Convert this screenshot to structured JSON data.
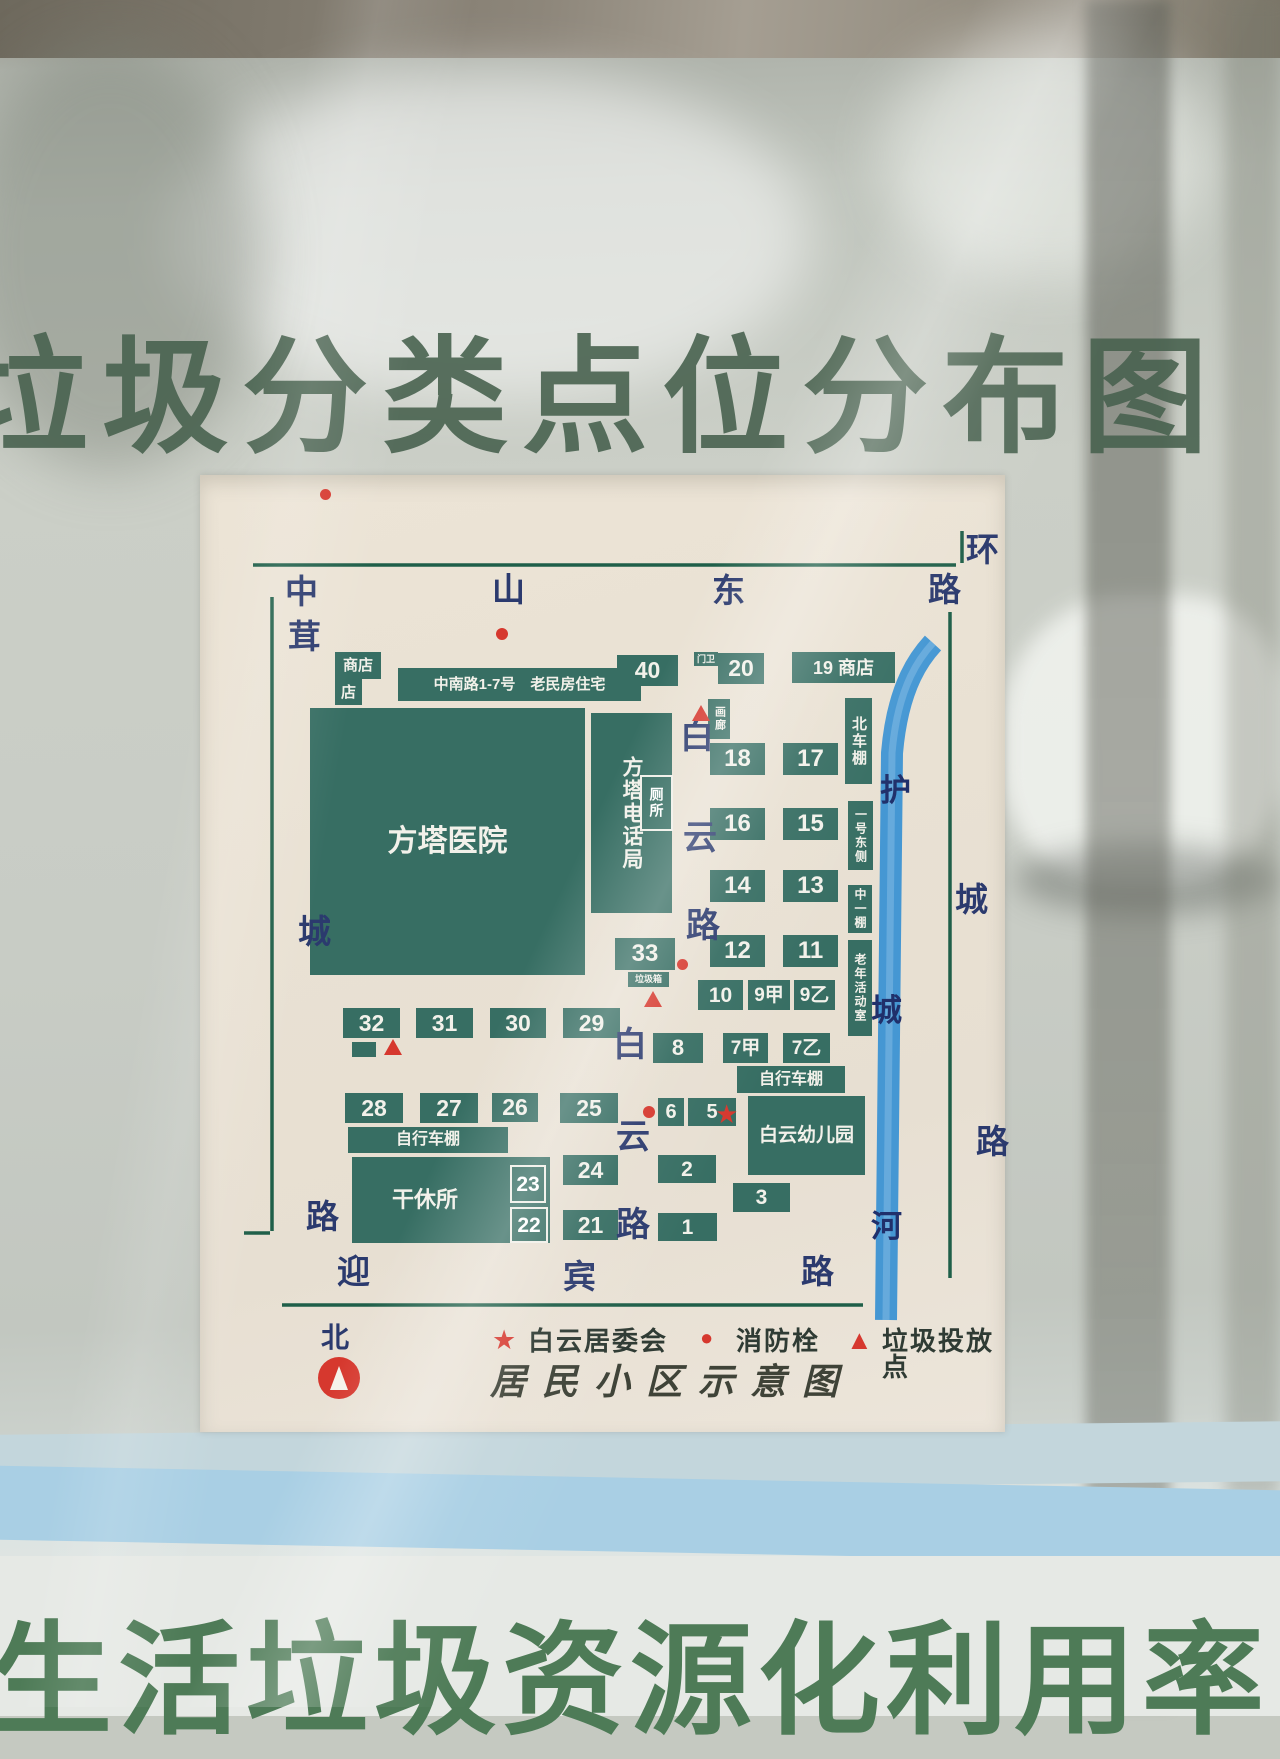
{
  "banners": {
    "top_title": "垃圾分类点位分布图",
    "bottom_banner": "生活垃圾资源化利用率"
  },
  "poster": {
    "caption": "居民小区示意图",
    "compass_label": "北",
    "road_names": {
      "top": "中山东路",
      "left": "茸城路",
      "right": "环城路",
      "bottom": "迎宾路",
      "inner": "白云路",
      "river": "护城河"
    },
    "legend": [
      {
        "symbol": "star",
        "glyph": "★",
        "label": "白云居委会"
      },
      {
        "symbol": "dot",
        "glyph": "●",
        "label": "消防栓"
      },
      {
        "symbol": "triangle",
        "glyph": "▲",
        "label": "垃圾投放点"
      }
    ],
    "colors": {
      "building_green": "#376e63",
      "road_line_green": "#1f5f49",
      "river_blue": "#4597d3",
      "marker_red": "#d6382e",
      "road_text_navy": "#2b3a6e"
    },
    "items": [
      {
        "name": "building-shop-upper",
        "type": "building",
        "x": 135,
        "y": 177,
        "w": 46,
        "h": 27,
        "label": "商店",
        "fs": 15
      },
      {
        "name": "building-shop-lower",
        "type": "building",
        "x": 135,
        "y": 204,
        "w": 27,
        "h": 26,
        "label": "店",
        "fs": 15
      },
      {
        "name": "building-zhongnan-housing",
        "type": "building",
        "x": 198,
        "y": 193,
        "w": 243,
        "h": 33,
        "label": "中南路1-7号　老民房住宅",
        "fs": 15
      },
      {
        "name": "building-40",
        "type": "building",
        "x": 417,
        "y": 180,
        "w": 61,
        "h": 31,
        "label": "40",
        "fs": 23
      },
      {
        "name": "label-gatehouse",
        "type": "building",
        "x": 494,
        "y": 177,
        "w": 24,
        "h": 14,
        "label": "门卫",
        "fs": 9
      },
      {
        "name": "building-20",
        "type": "building",
        "x": 518,
        "y": 178,
        "w": 46,
        "h": 31,
        "label": "20",
        "fs": 23
      },
      {
        "name": "building-19-shop",
        "type": "building",
        "x": 592,
        "y": 177,
        "w": 103,
        "h": 31,
        "label": "19 商店",
        "fs": 18
      },
      {
        "name": "building-fangta-hospital",
        "type": "building",
        "x": 110,
        "y": 233,
        "w": 275,
        "h": 267,
        "label": "方塔医院",
        "fs": 30
      },
      {
        "name": "building-fangta-telephone",
        "type": "building",
        "x": 391,
        "y": 238,
        "w": 81,
        "h": 200,
        "label": "方塔电话局",
        "fs": 21,
        "vertical": true
      },
      {
        "name": "building-toilet",
        "type": "outline",
        "x": 440,
        "y": 300,
        "w": 33,
        "h": 56,
        "label": "厕所",
        "fs": 14,
        "vertical": true
      },
      {
        "name": "building-gallery",
        "type": "building",
        "x": 508,
        "y": 224,
        "w": 22,
        "h": 40,
        "label": "画廊",
        "fs": 11,
        "vertical": true
      },
      {
        "name": "building-18",
        "type": "building",
        "x": 510,
        "y": 268,
        "w": 55,
        "h": 32,
        "label": "18",
        "fs": 24
      },
      {
        "name": "building-17",
        "type": "building",
        "x": 583,
        "y": 268,
        "w": 55,
        "h": 32,
        "label": "17",
        "fs": 24
      },
      {
        "name": "building-16",
        "type": "building",
        "x": 510,
        "y": 333,
        "w": 55,
        "h": 32,
        "label": "16",
        "fs": 24
      },
      {
        "name": "building-15",
        "type": "building",
        "x": 583,
        "y": 333,
        "w": 55,
        "h": 32,
        "label": "15",
        "fs": 24
      },
      {
        "name": "building-14",
        "type": "building",
        "x": 510,
        "y": 395,
        "w": 55,
        "h": 32,
        "label": "14",
        "fs": 24
      },
      {
        "name": "building-13",
        "type": "building",
        "x": 583,
        "y": 395,
        "w": 55,
        "h": 32,
        "label": "13",
        "fs": 24
      },
      {
        "name": "building-12",
        "type": "building",
        "x": 510,
        "y": 460,
        "w": 55,
        "h": 32,
        "label": "12",
        "fs": 24
      },
      {
        "name": "building-11",
        "type": "building",
        "x": 583,
        "y": 460,
        "w": 55,
        "h": 32,
        "label": "11",
        "fs": 24
      },
      {
        "name": "building-north-bike-shed",
        "type": "building",
        "x": 645,
        "y": 223,
        "w": 27,
        "h": 86,
        "label": "北车棚",
        "fs": 15,
        "vertical": true
      },
      {
        "name": "building-no1-east-side",
        "type": "building",
        "x": 648,
        "y": 326,
        "w": 25,
        "h": 69,
        "label": "一号东侧",
        "fs": 12,
        "vertical": true
      },
      {
        "name": "building-middle-shed",
        "type": "building",
        "x": 648,
        "y": 410,
        "w": 24,
        "h": 48,
        "label": "中一棚",
        "fs": 12,
        "vertical": true
      },
      {
        "name": "building-senior-activity-room",
        "type": "building",
        "x": 648,
        "y": 465,
        "w": 24,
        "h": 96,
        "label": "老年活动室",
        "fs": 12,
        "vertical": true
      },
      {
        "name": "building-33",
        "type": "building",
        "x": 415,
        "y": 463,
        "w": 60,
        "h": 32,
        "label": "33",
        "fs": 24
      },
      {
        "name": "label-garbage-bin",
        "type": "building",
        "x": 428,
        "y": 497,
        "w": 41,
        "h": 15,
        "label": "垃圾箱",
        "fs": 9
      },
      {
        "name": "building-10",
        "type": "building",
        "x": 498,
        "y": 505,
        "w": 45,
        "h": 30,
        "label": "10",
        "fs": 21
      },
      {
        "name": "building-9jia",
        "type": "building",
        "x": 548,
        "y": 505,
        "w": 42,
        "h": 30,
        "label": "9甲",
        "fs": 19
      },
      {
        "name": "building-9yi",
        "type": "building",
        "x": 594,
        "y": 505,
        "w": 41,
        "h": 30,
        "label": "9乙",
        "fs": 19
      },
      {
        "name": "building-32",
        "type": "building",
        "x": 143,
        "y": 533,
        "w": 57,
        "h": 30,
        "label": "32",
        "fs": 23
      },
      {
        "name": "building-31",
        "type": "building",
        "x": 216,
        "y": 533,
        "w": 57,
        "h": 30,
        "label": "31",
        "fs": 23
      },
      {
        "name": "building-30",
        "type": "building",
        "x": 290,
        "y": 533,
        "w": 56,
        "h": 30,
        "label": "30",
        "fs": 23
      },
      {
        "name": "building-29",
        "type": "building",
        "x": 363,
        "y": 533,
        "w": 57,
        "h": 30,
        "label": "29",
        "fs": 23
      },
      {
        "name": "rect-below-32",
        "type": "rect",
        "x": 152,
        "y": 567,
        "w": 24,
        "h": 15,
        "label": ""
      },
      {
        "name": "building-8",
        "type": "building",
        "x": 453,
        "y": 558,
        "w": 50,
        "h": 30,
        "label": "8",
        "fs": 22
      },
      {
        "name": "building-7jia",
        "type": "building",
        "x": 523,
        "y": 558,
        "w": 45,
        "h": 30,
        "label": "7甲",
        "fs": 19
      },
      {
        "name": "building-7yi",
        "type": "building",
        "x": 583,
        "y": 558,
        "w": 47,
        "h": 30,
        "label": "7乙",
        "fs": 19
      },
      {
        "name": "building-bike-shed-east",
        "type": "building",
        "x": 537,
        "y": 591,
        "w": 108,
        "h": 27,
        "label": "自行车棚",
        "fs": 16
      },
      {
        "name": "building-baiyun-kindergarten",
        "type": "building",
        "x": 548,
        "y": 621,
        "w": 117,
        "h": 79,
        "label": "白云幼儿园",
        "fs": 19
      },
      {
        "name": "building-28",
        "type": "building",
        "x": 145,
        "y": 618,
        "w": 58,
        "h": 30,
        "label": "28",
        "fs": 23
      },
      {
        "name": "building-27",
        "type": "building",
        "x": 220,
        "y": 618,
        "w": 58,
        "h": 30,
        "label": "27",
        "fs": 23
      },
      {
        "name": "building-26",
        "type": "building",
        "x": 292,
        "y": 618,
        "w": 46,
        "h": 29,
        "label": "26",
        "fs": 23
      },
      {
        "name": "building-25",
        "type": "building",
        "x": 360,
        "y": 618,
        "w": 58,
        "h": 30,
        "label": "25",
        "fs": 23
      },
      {
        "name": "building-6",
        "type": "building",
        "x": 458,
        "y": 623,
        "w": 26,
        "h": 28,
        "label": "6",
        "fs": 20
      },
      {
        "name": "building-5",
        "type": "building",
        "x": 488,
        "y": 623,
        "w": 48,
        "h": 28,
        "label": "5",
        "fs": 20
      },
      {
        "name": "building-bike-shed-west",
        "type": "building",
        "x": 148,
        "y": 652,
        "w": 160,
        "h": 26,
        "label": "自行车棚",
        "fs": 16
      },
      {
        "name": "building-ganxiusuo",
        "type": "building",
        "x": 152,
        "y": 682,
        "w": 198,
        "h": 86,
        "label": "干休所",
        "fs": 22,
        "padleft": true
      },
      {
        "name": "building-23",
        "type": "outline",
        "x": 310,
        "y": 690,
        "w": 36,
        "h": 38,
        "label": "23",
        "fs": 21
      },
      {
        "name": "building-22",
        "type": "outline",
        "x": 310,
        "y": 732,
        "w": 38,
        "h": 36,
        "label": "22",
        "fs": 21
      },
      {
        "name": "building-24",
        "type": "building",
        "x": 363,
        "y": 680,
        "w": 55,
        "h": 30,
        "label": "24",
        "fs": 23
      },
      {
        "name": "building-2",
        "type": "building",
        "x": 458,
        "y": 680,
        "w": 58,
        "h": 28,
        "label": "2",
        "fs": 21
      },
      {
        "name": "building-3",
        "type": "building",
        "x": 533,
        "y": 708,
        "w": 57,
        "h": 29,
        "label": "3",
        "fs": 21
      },
      {
        "name": "building-21",
        "type": "building",
        "x": 363,
        "y": 735,
        "w": 55,
        "h": 30,
        "label": "21",
        "fs": 23
      },
      {
        "name": "building-1",
        "type": "building",
        "x": 458,
        "y": 738,
        "w": 59,
        "h": 28,
        "label": "1",
        "fs": 21
      },
      {
        "name": "road-char-zhong",
        "type": "road-char",
        "x": 85,
        "y": 100,
        "label": "中",
        "fs": 33
      },
      {
        "name": "road-char-shan",
        "type": "road-char",
        "x": 292,
        "y": 98,
        "label": "山",
        "fs": 33
      },
      {
        "name": "road-char-dong",
        "type": "road-char",
        "x": 512,
        "y": 99,
        "label": "东",
        "fs": 33
      },
      {
        "name": "road-char-lu-top",
        "type": "road-char",
        "x": 728,
        "y": 98,
        "label": "路",
        "fs": 33
      },
      {
        "name": "road-char-rong",
        "type": "road-char",
        "x": 88,
        "y": 145,
        "label": "茸",
        "fs": 33
      },
      {
        "name": "road-char-cheng-left",
        "type": "road-char",
        "x": 98,
        "y": 440,
        "label": "城",
        "fs": 33
      },
      {
        "name": "road-char-lu-left",
        "type": "road-char",
        "x": 106,
        "y": 725,
        "label": "路",
        "fs": 33
      },
      {
        "name": "road-char-huan",
        "type": "road-char",
        "x": 766,
        "y": 58,
        "label": "环",
        "fs": 33
      },
      {
        "name": "road-char-cheng-right",
        "type": "road-char",
        "x": 755,
        "y": 408,
        "label": "城",
        "fs": 33
      },
      {
        "name": "road-char-lu-right",
        "type": "road-char",
        "x": 776,
        "y": 650,
        "label": "路",
        "fs": 33
      },
      {
        "name": "road-char-ying",
        "type": "road-char",
        "x": 137,
        "y": 780,
        "label": "迎",
        "fs": 33
      },
      {
        "name": "road-char-bin",
        "type": "road-char",
        "x": 363,
        "y": 785,
        "label": "宾",
        "fs": 33
      },
      {
        "name": "road-char-lu-bottom",
        "type": "road-char",
        "x": 601,
        "y": 780,
        "label": "路",
        "fs": 33
      },
      {
        "name": "road-char-bai-upper",
        "type": "road-char",
        "x": 480,
        "y": 245,
        "label": "白",
        "fs": 34
      },
      {
        "name": "road-char-yun-upper",
        "type": "road-char",
        "x": 483,
        "y": 346,
        "label": "云",
        "fs": 34
      },
      {
        "name": "road-char-lu-upper",
        "type": "road-char",
        "x": 486,
        "y": 434,
        "label": "路",
        "fs": 34
      },
      {
        "name": "road-char-bai-lower",
        "type": "road-char",
        "x": 413,
        "y": 553,
        "label": "白",
        "fs": 34
      },
      {
        "name": "road-char-yun-lower",
        "type": "road-char",
        "x": 416,
        "y": 645,
        "label": "云",
        "fs": 34
      },
      {
        "name": "road-char-lu-lower",
        "type": "road-char",
        "x": 416,
        "y": 733,
        "label": "路",
        "fs": 34
      },
      {
        "name": "river-char-hu",
        "type": "river-char",
        "x": 680,
        "y": 300,
        "label": "护",
        "fs": 31
      },
      {
        "name": "river-char-cheng",
        "type": "river-char",
        "x": 671,
        "y": 520,
        "label": "城",
        "fs": 31
      },
      {
        "name": "river-char-he",
        "type": "river-char",
        "x": 671,
        "y": 736,
        "label": "河",
        "fs": 31
      },
      {
        "name": "hydrant-dot-1",
        "type": "dot",
        "x": 120,
        "y": 14,
        "w": 11,
        "h": 11
      },
      {
        "name": "hydrant-dot-2",
        "type": "dot",
        "x": 296,
        "y": 153,
        "w": 12,
        "h": 12
      },
      {
        "name": "hydrant-dot-3",
        "type": "dot",
        "x": 477,
        "y": 484,
        "w": 11,
        "h": 11
      },
      {
        "name": "hydrant-dot-4",
        "type": "dot",
        "x": 443,
        "y": 631,
        "w": 12,
        "h": 12
      },
      {
        "name": "garbage-triangle-1",
        "type": "triangle",
        "x": 492,
        "y": 230
      },
      {
        "name": "garbage-triangle-2",
        "type": "triangle",
        "x": 444,
        "y": 516
      },
      {
        "name": "garbage-triangle-3",
        "type": "triangle",
        "x": 184,
        "y": 564
      },
      {
        "name": "committee-star",
        "type": "star",
        "x": 515,
        "y": 626,
        "label": "★",
        "fs": 26
      }
    ]
  }
}
